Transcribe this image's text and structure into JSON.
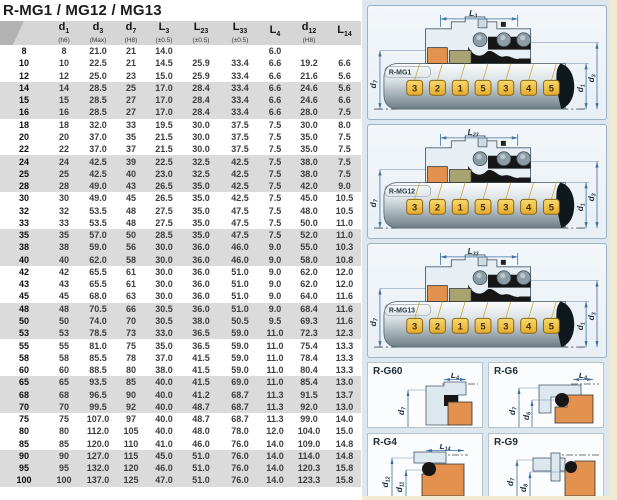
{
  "title": "R-MG1 / MG12 / MG13",
  "table": {
    "headers": [
      {
        "base": "",
        "sub": "",
        "tol": ""
      },
      {
        "base": "d",
        "sub": "1",
        "tol": "(h6)"
      },
      {
        "base": "d",
        "sub": "3",
        "tol": "(Max)"
      },
      {
        "base": "d",
        "sub": "7",
        "tol": "(H8)"
      },
      {
        "base": "L",
        "sub": "3",
        "tol": "(±0.5)"
      },
      {
        "base": "L",
        "sub": "23",
        "tol": "(±0.5)"
      },
      {
        "base": "L",
        "sub": "33",
        "tol": "(±0.5)"
      },
      {
        "base": "L",
        "sub": "4",
        "tol": ""
      },
      {
        "base": "d",
        "sub": "12",
        "tol": "(H8)"
      },
      {
        "base": "L",
        "sub": "14",
        "tol": ""
      }
    ],
    "rows": [
      [
        "8",
        "8",
        "21.0",
        "21",
        "14.0",
        "",
        "",
        "6.0",
        "",
        ""
      ],
      [
        "10",
        "10",
        "22.5",
        "21",
        "14.5",
        "25.9",
        "33.4",
        "6.6",
        "19.2",
        "6.6"
      ],
      [
        "12",
        "12",
        "25.0",
        "23",
        "15.0",
        "25.9",
        "33.4",
        "6.6",
        "21.6",
        "5.6"
      ],
      [
        "14",
        "14",
        "28.5",
        "25",
        "17.0",
        "28.4",
        "33.4",
        "6.6",
        "24.6",
        "5.6"
      ],
      [
        "15",
        "15",
        "28.5",
        "27",
        "17.0",
        "28.4",
        "33.4",
        "6.6",
        "24.6",
        "6.6"
      ],
      [
        "16",
        "16",
        "28.5",
        "27",
        "17.0",
        "28.4",
        "33.4",
        "6.6",
        "28.0",
        "7.5"
      ],
      [
        "18",
        "18",
        "32.0",
        "33",
        "19.5",
        "30.0",
        "37.5",
        "7.5",
        "30.0",
        "8.0"
      ],
      [
        "20",
        "20",
        "37.0",
        "35",
        "21.5",
        "30.0",
        "37.5",
        "7.5",
        "35.0",
        "7.5"
      ],
      [
        "22",
        "22",
        "37.0",
        "37",
        "21.5",
        "30.0",
        "37.5",
        "7.5",
        "35.0",
        "7.5"
      ],
      [
        "24",
        "24",
        "42.5",
        "39",
        "22.5",
        "32.5",
        "42.5",
        "7.5",
        "38.0",
        "7.5"
      ],
      [
        "25",
        "25",
        "42.5",
        "40",
        "23.0",
        "32.5",
        "42.5",
        "7.5",
        "38.0",
        "7.5"
      ],
      [
        "28",
        "28",
        "49.0",
        "43",
        "26.5",
        "35.0",
        "42.5",
        "7.5",
        "42.0",
        "9.0"
      ],
      [
        "30",
        "30",
        "49.0",
        "45",
        "26.5",
        "35.0",
        "42.5",
        "7.5",
        "45.0",
        "10.5"
      ],
      [
        "32",
        "32",
        "53.5",
        "48",
        "27.5",
        "35.0",
        "47.5",
        "7.5",
        "48.0",
        "10.5"
      ],
      [
        "33",
        "33",
        "53.5",
        "48",
        "27.5",
        "35.0",
        "47.5",
        "7.5",
        "50.0",
        "11.0"
      ],
      [
        "35",
        "35",
        "57.0",
        "50",
        "28.5",
        "35.0",
        "47.5",
        "7.5",
        "52.0",
        "11.0"
      ],
      [
        "38",
        "38",
        "59.0",
        "56",
        "30.0",
        "36.0",
        "46.0",
        "9.0",
        "55.0",
        "10.3"
      ],
      [
        "40",
        "40",
        "62.0",
        "58",
        "30.0",
        "36.0",
        "46.0",
        "9.0",
        "58.0",
        "10.8"
      ],
      [
        "42",
        "42",
        "65.5",
        "61",
        "30.0",
        "36.0",
        "51.0",
        "9.0",
        "62.0",
        "12.0"
      ],
      [
        "43",
        "43",
        "65.5",
        "61",
        "30.0",
        "36.0",
        "51.0",
        "9.0",
        "62.0",
        "12.0"
      ],
      [
        "45",
        "45",
        "68.0",
        "63",
        "30.0",
        "36.0",
        "51.0",
        "9.0",
        "64.0",
        "11.6"
      ],
      [
        "48",
        "48",
        "70.5",
        "66",
        "30.5",
        "36.0",
        "51.0",
        "9.0",
        "68.4",
        "11.6"
      ],
      [
        "50",
        "50",
        "74.0",
        "70",
        "30.5",
        "38.0",
        "50.5",
        "9.5",
        "69.3",
        "11.6"
      ],
      [
        "53",
        "53",
        "78.5",
        "73",
        "33.0",
        "36.5",
        "59.0",
        "11.0",
        "72.3",
        "12.3"
      ],
      [
        "55",
        "55",
        "81.0",
        "75",
        "35.0",
        "36.5",
        "59.0",
        "11.0",
        "75.4",
        "13.3"
      ],
      [
        "58",
        "58",
        "85.5",
        "78",
        "37.0",
        "41.5",
        "59.0",
        "11.0",
        "78.4",
        "13.3"
      ],
      [
        "60",
        "60",
        "88.5",
        "80",
        "38.0",
        "41.5",
        "59.0",
        "11.0",
        "80.4",
        "13.3"
      ],
      [
        "65",
        "65",
        "93.5",
        "85",
        "40.0",
        "41.5",
        "69.0",
        "11.0",
        "85.4",
        "13.0"
      ],
      [
        "68",
        "68",
        "96.5",
        "90",
        "40.0",
        "41.2",
        "68.7",
        "11.3",
        "91.5",
        "13.7"
      ],
      [
        "70",
        "70",
        "99.5",
        "92",
        "40.0",
        "48.7",
        "68.7",
        "11.3",
        "92.0",
        "13.0"
      ],
      [
        "75",
        "75",
        "107.0",
        "97",
        "40.0",
        "48.7",
        "68.7",
        "11.3",
        "99.0",
        "14.0"
      ],
      [
        "80",
        "80",
        "112.0",
        "105",
        "40.0",
        "48.0",
        "78.0",
        "12.0",
        "104.0",
        "15.0"
      ],
      [
        "85",
        "85",
        "120.0",
        "110",
        "41.0",
        "46.0",
        "76.0",
        "14.0",
        "109.0",
        "14.8"
      ],
      [
        "90",
        "90",
        "127.0",
        "115",
        "45.0",
        "51.0",
        "76.0",
        "14.0",
        "114.0",
        "14.8"
      ],
      [
        "95",
        "95",
        "132.0",
        "120",
        "46.0",
        "51.0",
        "76.0",
        "14.0",
        "120.3",
        "15.8"
      ],
      [
        "100",
        "100",
        "137.0",
        "125",
        "47.0",
        "51.0",
        "76.0",
        "14.0",
        "123.3",
        "15.8"
      ]
    ]
  },
  "main_diagrams": [
    {
      "name": "R-MG1",
      "length_dim": {
        "base": "L",
        "sub": "3"
      },
      "bore_dim": {
        "base": "d",
        "sub": "7"
      },
      "shaft_dims": [
        {
          "base": "d",
          "sub": "1"
        },
        {
          "base": "d",
          "sub": "3"
        }
      ],
      "part_tags": [
        "3",
        "2",
        "1",
        "5",
        "3",
        "4",
        "5"
      ]
    },
    {
      "name": "R-MG12",
      "length_dim": {
        "base": "L",
        "sub": "23"
      },
      "bore_dim": {
        "base": "d",
        "sub": "7"
      },
      "shaft_dims": [
        {
          "base": "d",
          "sub": "1"
        },
        {
          "base": "d",
          "sub": "3"
        }
      ],
      "part_tags": [
        "3",
        "2",
        "1",
        "5",
        "3",
        "4",
        "5"
      ]
    },
    {
      "name": "R-MG13",
      "length_dim": {
        "base": "L",
        "sub": "33"
      },
      "bore_dim": {
        "base": "d",
        "sub": "7"
      },
      "shaft_dims": [
        {
          "base": "d",
          "sub": "1"
        },
        {
          "base": "d",
          "sub": "3"
        }
      ],
      "part_tags": [
        "3",
        "2",
        "1",
        "5",
        "3",
        "4",
        "5"
      ]
    }
  ],
  "detail_diagrams": [
    {
      "name": "R-G60",
      "variant": "g60",
      "length_dim": {
        "base": "L",
        "sub": "4"
      },
      "dia_dims": [
        {
          "base": "d",
          "sub": "7"
        }
      ]
    },
    {
      "name": "R-G6",
      "variant": "g6",
      "length_dim": {
        "base": "L",
        "sub": "4"
      },
      "dia_dims": [
        {
          "base": "d",
          "sub": "7"
        },
        {
          "base": "d",
          "sub": "6"
        }
      ]
    },
    {
      "name": "R-G4",
      "variant": "g4",
      "length_dim": {
        "base": "L",
        "sub": "14"
      },
      "dia_dims": [
        {
          "base": "d",
          "sub": "12"
        },
        {
          "base": "d",
          "sub": "11"
        }
      ]
    },
    {
      "name": "R-G9",
      "variant": "g9",
      "length_dim": null,
      "dia_dims": [
        {
          "base": "d",
          "sub": "7"
        },
        {
          "base": "d",
          "sub": "8"
        }
      ]
    }
  ],
  "colors": {
    "dimension_blue": "#3f6f9f",
    "tag_yellow": "#f2c44c",
    "tag_border": "#8a6714",
    "seal_orange": "#e2914e",
    "seal_olive": "#a8a471",
    "panel_blue_gray": "#dfe7ee",
    "row_band_gray": "#dbdbdb",
    "page_edge_cream": "#f1e9d2"
  }
}
